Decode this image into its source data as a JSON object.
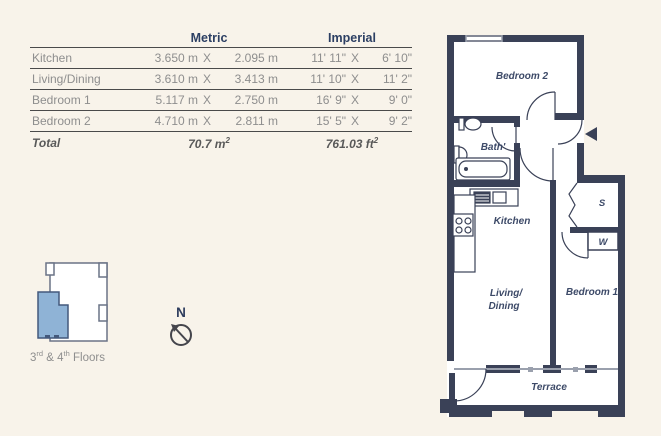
{
  "table": {
    "headers": {
      "metric": "Metric",
      "imperial": "Imperial"
    },
    "rows": [
      {
        "room": "Kitchen",
        "metric_w": "3.650 m",
        "x1": "X",
        "metric_h": "2.095 m",
        "imp_w": "11' 11\"",
        "x2": "X",
        "imp_h": "6' 10\""
      },
      {
        "room": "Living/Dining",
        "metric_w": "3.610 m",
        "x1": "X",
        "metric_h": "3.413 m",
        "imp_w": "11' 10\"",
        "x2": "X",
        "imp_h": "11' 2\""
      },
      {
        "room": "Bedroom 1",
        "metric_w": "5.117 m",
        "x1": "X",
        "metric_h": "2.750 m",
        "imp_w": "16' 9\"",
        "x2": "X",
        "imp_h": "9' 0\""
      },
      {
        "room": "Bedroom 2",
        "metric_w": "4.710 m",
        "x1": "X",
        "metric_h": "2.811 m",
        "imp_w": "15' 5\"",
        "x2": "X",
        "imp_h": "9' 2\""
      }
    ],
    "total": {
      "label": "Total",
      "metric_value": "70.7 m",
      "metric_sup": "2",
      "imperial_value": "761.03 ft",
      "imperial_sup": "2"
    }
  },
  "plan": {
    "rooms": {
      "bedroom2": "Bedroom 2",
      "bath": "Bath'",
      "kitchen": "Kitchen",
      "living_line1": "Living/",
      "living_line2": "Dining",
      "bedroom1": "Bedroom 1",
      "terrace": "Terrace",
      "storage": "S",
      "wardrobe": "W"
    }
  },
  "key_plan": {
    "floors_prefix": "3",
    "floors_sup1": "rd",
    "floors_mid": " & 4",
    "floors_sup2": "th",
    "floors_suffix": " Floors"
  },
  "compass": {
    "label": "N"
  },
  "colors": {
    "background": "#f8f3ea",
    "wall": "#3a4157",
    "room_label": "#3d4a68",
    "table_header": "#2c3f63",
    "table_text": "#8e8e8e",
    "rule": "#4a4a4a",
    "key_highlight": "#8fb3d6",
    "key_outline": "#6a7386"
  }
}
